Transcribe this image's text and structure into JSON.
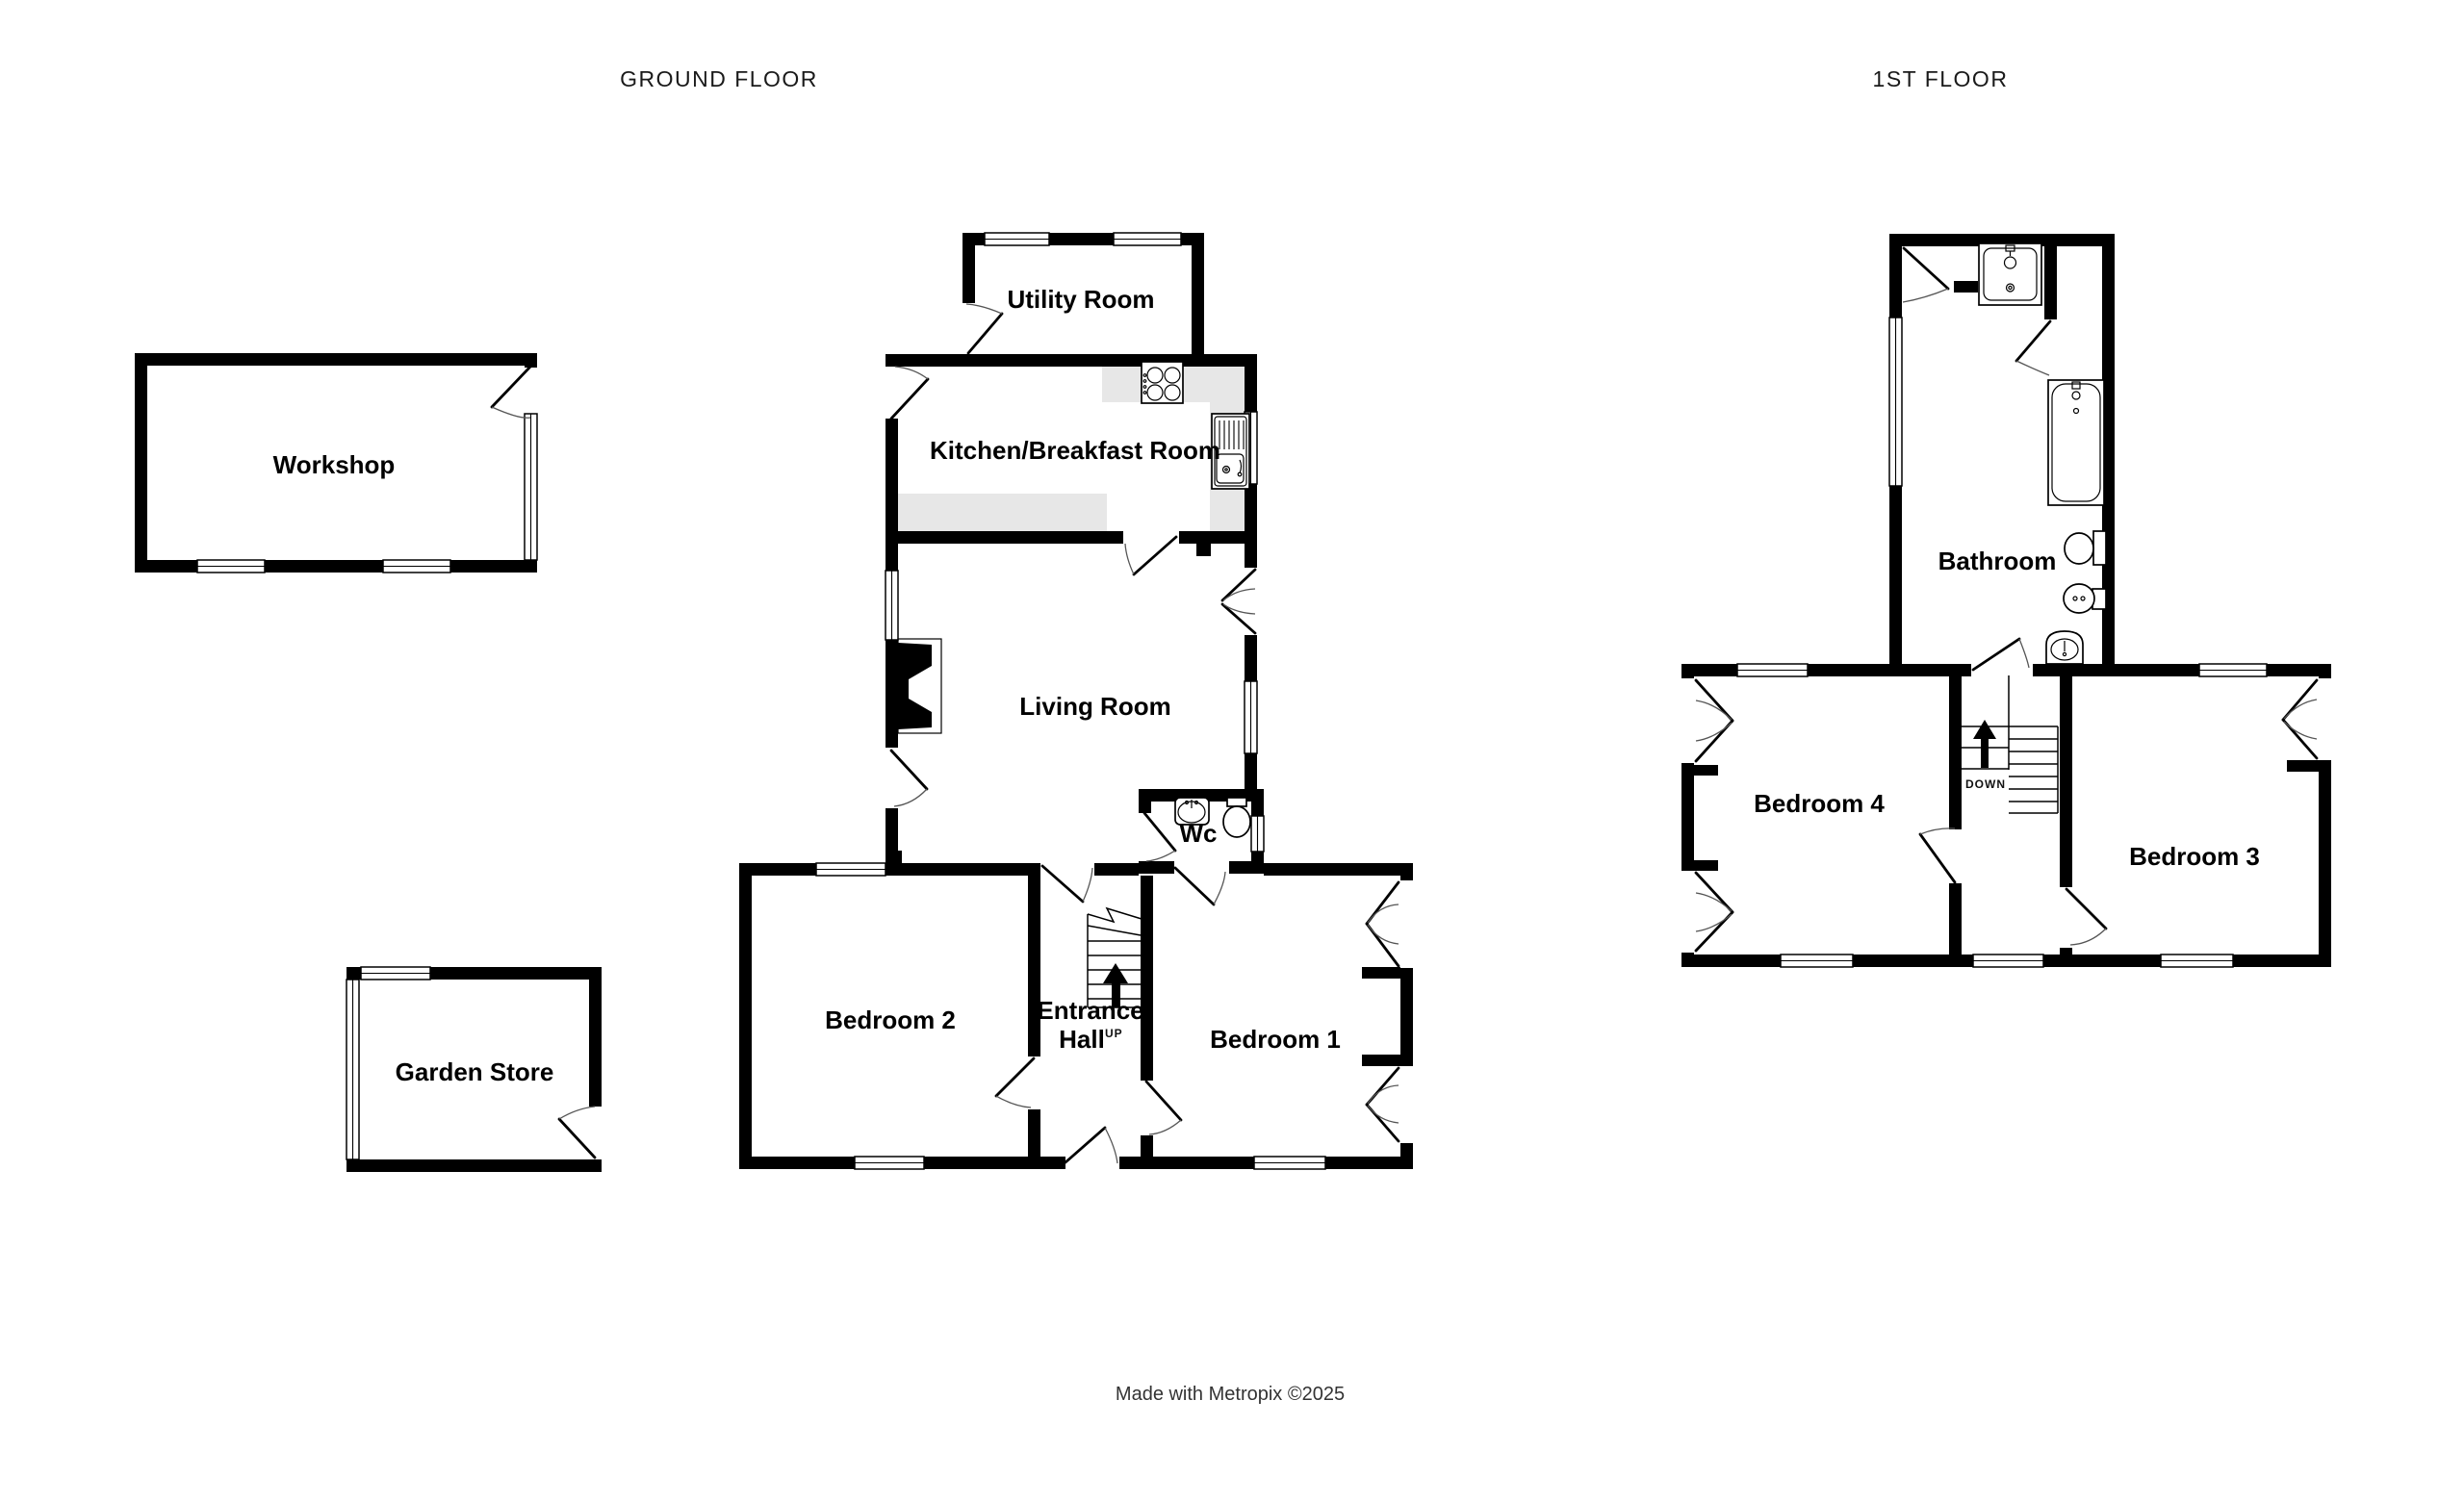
{
  "titles": {
    "ground_floor": "GROUND FLOOR",
    "first_floor": "1ST FLOOR"
  },
  "ground_floor": {
    "rooms": {
      "workshop": "Workshop",
      "utility_room": "Utility Room",
      "kitchen_breakfast_room": "Kitchen/Breakfast Room",
      "living_room": "Living Room",
      "wc": "Wc",
      "entrance_hall_line1": "Entrance",
      "entrance_hall_line2": "Hall",
      "bedroom_2": "Bedroom 2",
      "bedroom_1": "Bedroom 1",
      "garden_store": "Garden Store"
    },
    "stairs": {
      "direction_label": "UP"
    }
  },
  "first_floor": {
    "rooms": {
      "bathroom": "Bathroom",
      "bedroom_4": "Bedroom 4",
      "bedroom_3": "Bedroom 3"
    },
    "stairs": {
      "direction_label": "DOWN"
    }
  },
  "footer": {
    "credit": "Made with Metropix ©2025"
  },
  "fixtures": [
    "hob",
    "kitchen-sink",
    "fireplace",
    "wc-basin",
    "toilet",
    "shower",
    "bathtub",
    "bidet",
    "pedestal-basin"
  ],
  "colors": {
    "walls": "#000000",
    "kitchen_counter": "#e7e7e7",
    "background": "#ffffff",
    "door_swing": "#555555"
  }
}
